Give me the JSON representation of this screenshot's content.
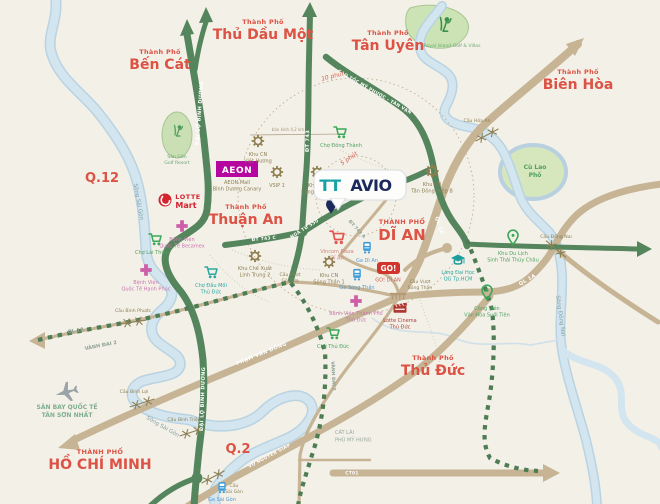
{
  "logo": {
    "part1": "TT",
    "part2": "AVIO"
  },
  "cities": {
    "prefix": "Thành Phố",
    "prefix_caps": "THÀNH PHỐ",
    "ben_cat": "Bến Cát",
    "thu_dau_mot": "Thủ Dầu Một",
    "tan_uyen": "Tân Uyên",
    "bien_hoa": "Biên Hòa",
    "thuan_an": "Thuận An",
    "di_an": "DĨ AN",
    "thu_duc": "Thủ Đức",
    "ho_chi_minh": "HỒ CHÍ MINH",
    "q12": "Q.12",
    "q2": "Q.2"
  },
  "roads": {
    "dai_lo_binh_duong": "ĐẠI LỘ BÌNH DƯƠNG",
    "dt743": "ĐT 743",
    "dt743a": "ĐT 743 A",
    "dt743c": "ĐT 743 C",
    "cao_toc_mptv": "CAO TỐC MỸ PHƯỚC - TÂN VẠN",
    "ql1a": "QL 1A",
    "ql1k": "QL 1K",
    "vanh_dai_2": "VÀNH ĐAI 2",
    "pham_van_dong": "PHẠM VĂN ĐỒNG",
    "vo_nguyen_giap": "VÕ NGUYÊN GIÁP",
    "ct01": "CT01",
    "nga_tu_550": "NGÃ TƯ 550"
  },
  "rivers": {
    "song_sai_gon": "Sông Sài Gòn",
    "song_dong_nai": "Sông Đồng Nai",
    "cu_lao_1": "Cù Lao",
    "cu_lao_2": "Phố"
  },
  "bridges": {
    "hoa_an": "Cầu Hóa An",
    "dong_nai": "Cầu Đồng Nai",
    "binh_phuoc": "Cầu Bình Phước",
    "binh_loi": "Cầu Bình Lợi",
    "binh_trieu": "Cầu Bình Triệu",
    "sai_gon_1": "Cầu",
    "sai_gon_2": "Sài Gòn",
    "vuot_go_dua_1": "Cầu Vượt",
    "vuot_go_dua_2": "Gò Dưa",
    "vuot_song_than_1": "Cầu Vượt",
    "vuot_song_than_2": "Sóng Thần"
  },
  "rings": {
    "five": "5 phút",
    "ten": "10 phút",
    "radius_note": "bán kính 4,2 km"
  },
  "areas": {
    "cat_lai": "CÁT LÁI",
    "phu_my_hung": "PHÚ MỸ HƯNG"
  },
  "pois": {
    "aeon": {
      "logo": "AEON",
      "l1": "AEON Mall",
      "l2": "Bình Dương Canary"
    },
    "lotte": {
      "l1": "LOTTE",
      "l2": "Mart"
    },
    "go": {
      "logo": "GO!",
      "label": "GO! DĨ AN"
    },
    "golf_resort": {
      "l1": "Sân Gôn",
      "l2": "Golf Resort"
    },
    "royal_golf": {
      "label": "Royal Island Golf & Villas"
    },
    "viet_huong": {
      "l1": "Khu CN",
      "l2": "Việt Hương"
    },
    "vsip1": {
      "l1": "VSIP 1"
    },
    "song_than_2": {
      "l1": "Khu CN",
      "l2": "Sóng Thần 2"
    },
    "song_than_1": {
      "l1": "Khu CN",
      "l2": "Sóng Thần 1"
    },
    "tan_dong_hiep": {
      "l1": "Khu CN",
      "l2": "Tân Đông Hiệp B"
    },
    "linh_trung": {
      "l1": "Khu Chế Xuất",
      "l2": "Linh Trung 2"
    },
    "cho_lai_thieu": {
      "label": "Chợ Lái Thiêu"
    },
    "cho_dong_thanh": {
      "label": "Chợ Đông Thành"
    },
    "cho_dau_moi": {
      "l1": "Chợ Đầu Mối",
      "l2": "Thủ Đức"
    },
    "cho_thu_duc": {
      "label": "Chợ Thủ Đức"
    },
    "vincom": {
      "l1": "Vincom Plaza",
      "l2": "Dĩ An"
    },
    "ga_di_an": {
      "label": "Ga Dĩ An"
    },
    "ga_song_than": {
      "label": "Ga Sóng Thần"
    },
    "ga_sai_gon": {
      "label": "Ga Sài Gòn"
    },
    "lang_dai_hoc": {
      "l1": "Làng Đại Học",
      "l2": "QG Tp.HCM"
    },
    "thuy_chau": {
      "l1": "Khu Du Lịch",
      "l2": "Sinh Thái Thủy Châu"
    },
    "suoi_tien": {
      "l1": "Công Viên",
      "l2": "Văn Hóa Suối Tiên"
    },
    "becamex": {
      "l1": "Bệnh Viện",
      "l2": "Quốc Tế Becamex"
    },
    "hanh_phuc": {
      "l1": "Bệnh Viện",
      "l2": "Quốc Tế Hạnh Phúc"
    },
    "bv_thu_duc": {
      "l1": "Bệnh Viện Thành Phố",
      "l2": "Thủ Đức"
    },
    "lotte_cinema": {
      "l1": "Lotte Cinema",
      "l2": "Thủ Đức"
    },
    "san_bay": {
      "l1": "SÂN BAY QUỐC TẾ",
      "l2": "TÂN SƠN NHẤT"
    }
  },
  "colors": {
    "background": "#f3f0e8",
    "road_green": "#55855c",
    "road_tan": "#c6b494",
    "river": "#cfe2ee",
    "city_red": "#dc5244",
    "logo_teal": "#17a3a6",
    "logo_navy": "#1b2a5c",
    "aeon_magenta": "#b5079f",
    "go_red": "#d0342c",
    "lotte_red": "#d5232e"
  }
}
